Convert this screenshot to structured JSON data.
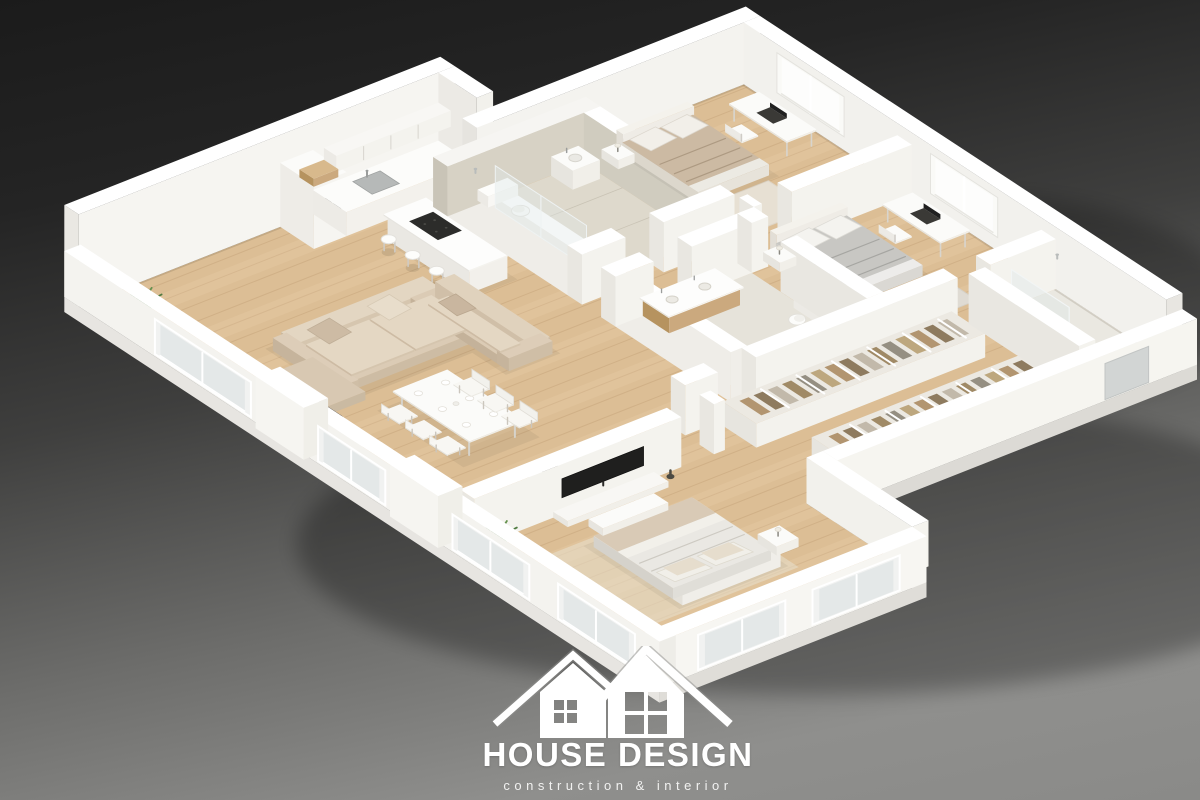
{
  "logo": {
    "title": "HOUSE DESIGN",
    "subtitle": "construction & interior"
  },
  "palette": {
    "background_top": "#1b1b1b",
    "background_bottom": "#8f8f8d",
    "wall_top": "#ffffff",
    "wall_light": "#f6f5f1",
    "wall_mid": "#efede8",
    "wall_shade": "#e3e1db",
    "floor_wood": "#dcbe95",
    "floor_wood_line": "#a97f4f",
    "floor_stone": "#ded9cc",
    "stone_wall": "#d7d2c5",
    "sofa": "#d9c9b3",
    "bed_beige": "#ccbaa3",
    "bed_gray": "#c8c7c3",
    "bed_white": "#eae8e3",
    "wood_furniture": "#c9a87c",
    "tv_screen": "#1f1f1e",
    "glass": "#e4e8e8",
    "plant_green": "#4f7b41",
    "logo_white": "#ffffff"
  },
  "rooms": [
    "living-room",
    "kitchen",
    "dining-area",
    "bathroom-1",
    "bedroom-1",
    "bedroom-2",
    "bathroom-2",
    "walk-in-closet",
    "shower-room",
    "master-bedroom",
    "balcony-windows"
  ]
}
